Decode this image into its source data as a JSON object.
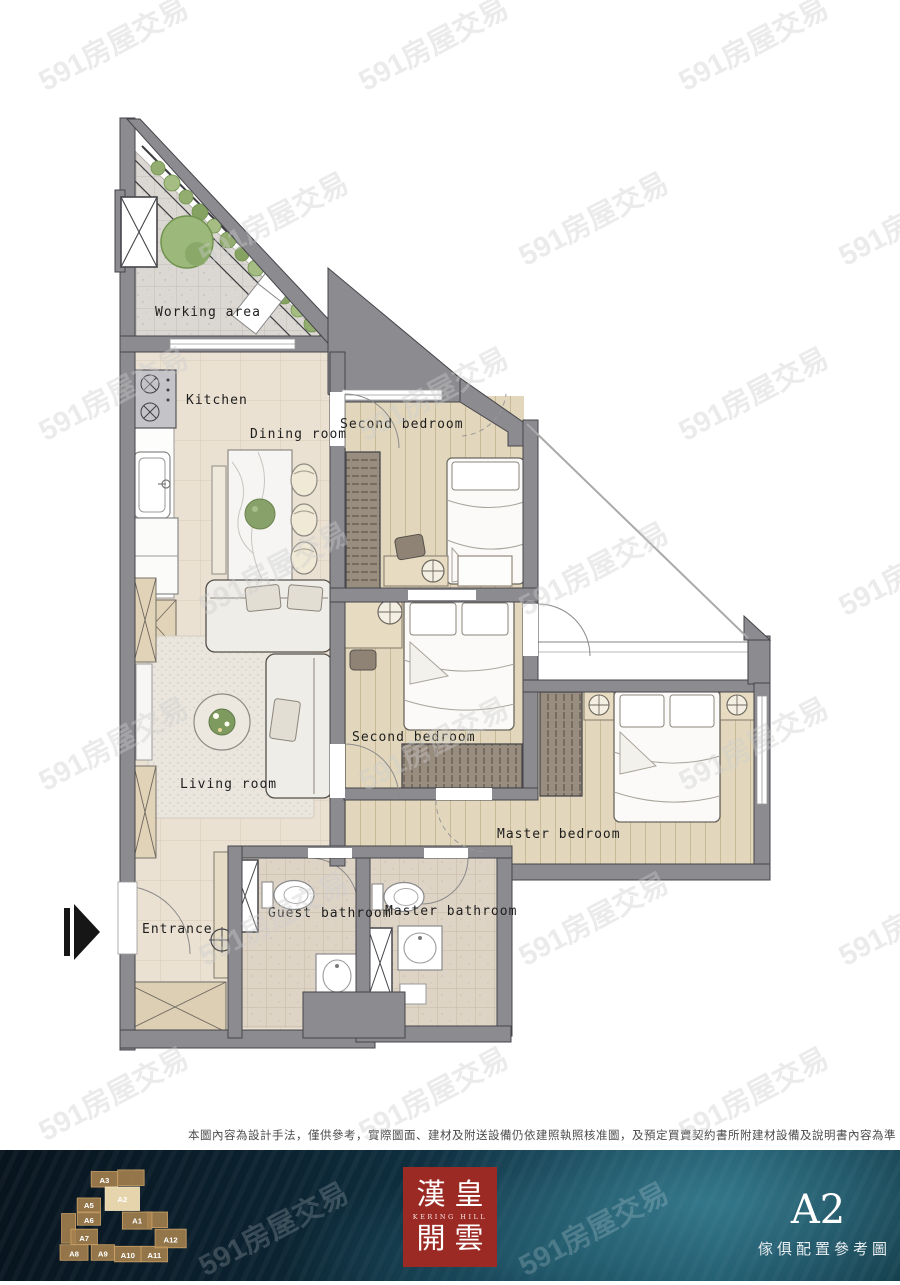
{
  "watermark": {
    "text": "591房屋交易"
  },
  "rooms": {
    "working_area": "Working area",
    "kitchen": "Kitchen",
    "dining": "Dining room",
    "second_bedroom_top": "Second bedroom",
    "second_bedroom_mid": "Second bedroom",
    "living": "Living room",
    "master_bedroom": "Master bedroom",
    "entrance": "Entrance",
    "guest_bath": "Guest bathroom",
    "master_bath": "Master bathroom"
  },
  "disclaimer": "本圖內容為設計手法，僅供參考，實際圖面、建材及附送設備仍依建照執照核准圖，及預定買賣契約書所附建材設備及說明書內容為準",
  "footer": {
    "logo": {
      "line1": "漢皇",
      "subtitle": "KERING HILL",
      "line2": "開雲",
      "bg": "#9b2a24"
    },
    "unit_label": "A2",
    "caption": "傢俱配置參考圖",
    "keyplan": {
      "highlight": "A2",
      "units": [
        "A3",
        "A2",
        "A5",
        "A6",
        "A1",
        "A7",
        "A8",
        "A9",
        "A10",
        "A11",
        "A12"
      ]
    }
  },
  "colors": {
    "wall": "#8b8b90",
    "wood_floor": "#e2d7bc",
    "tile_floor": "#eae1d2",
    "bath_tile": "#ded4c6",
    "stone": "#dbd8d3",
    "greenery": "#9cb87b",
    "footer_navy": "#0b2230",
    "logo_red": "#9b2a24",
    "keyplan_gold": "#c9a267"
  }
}
